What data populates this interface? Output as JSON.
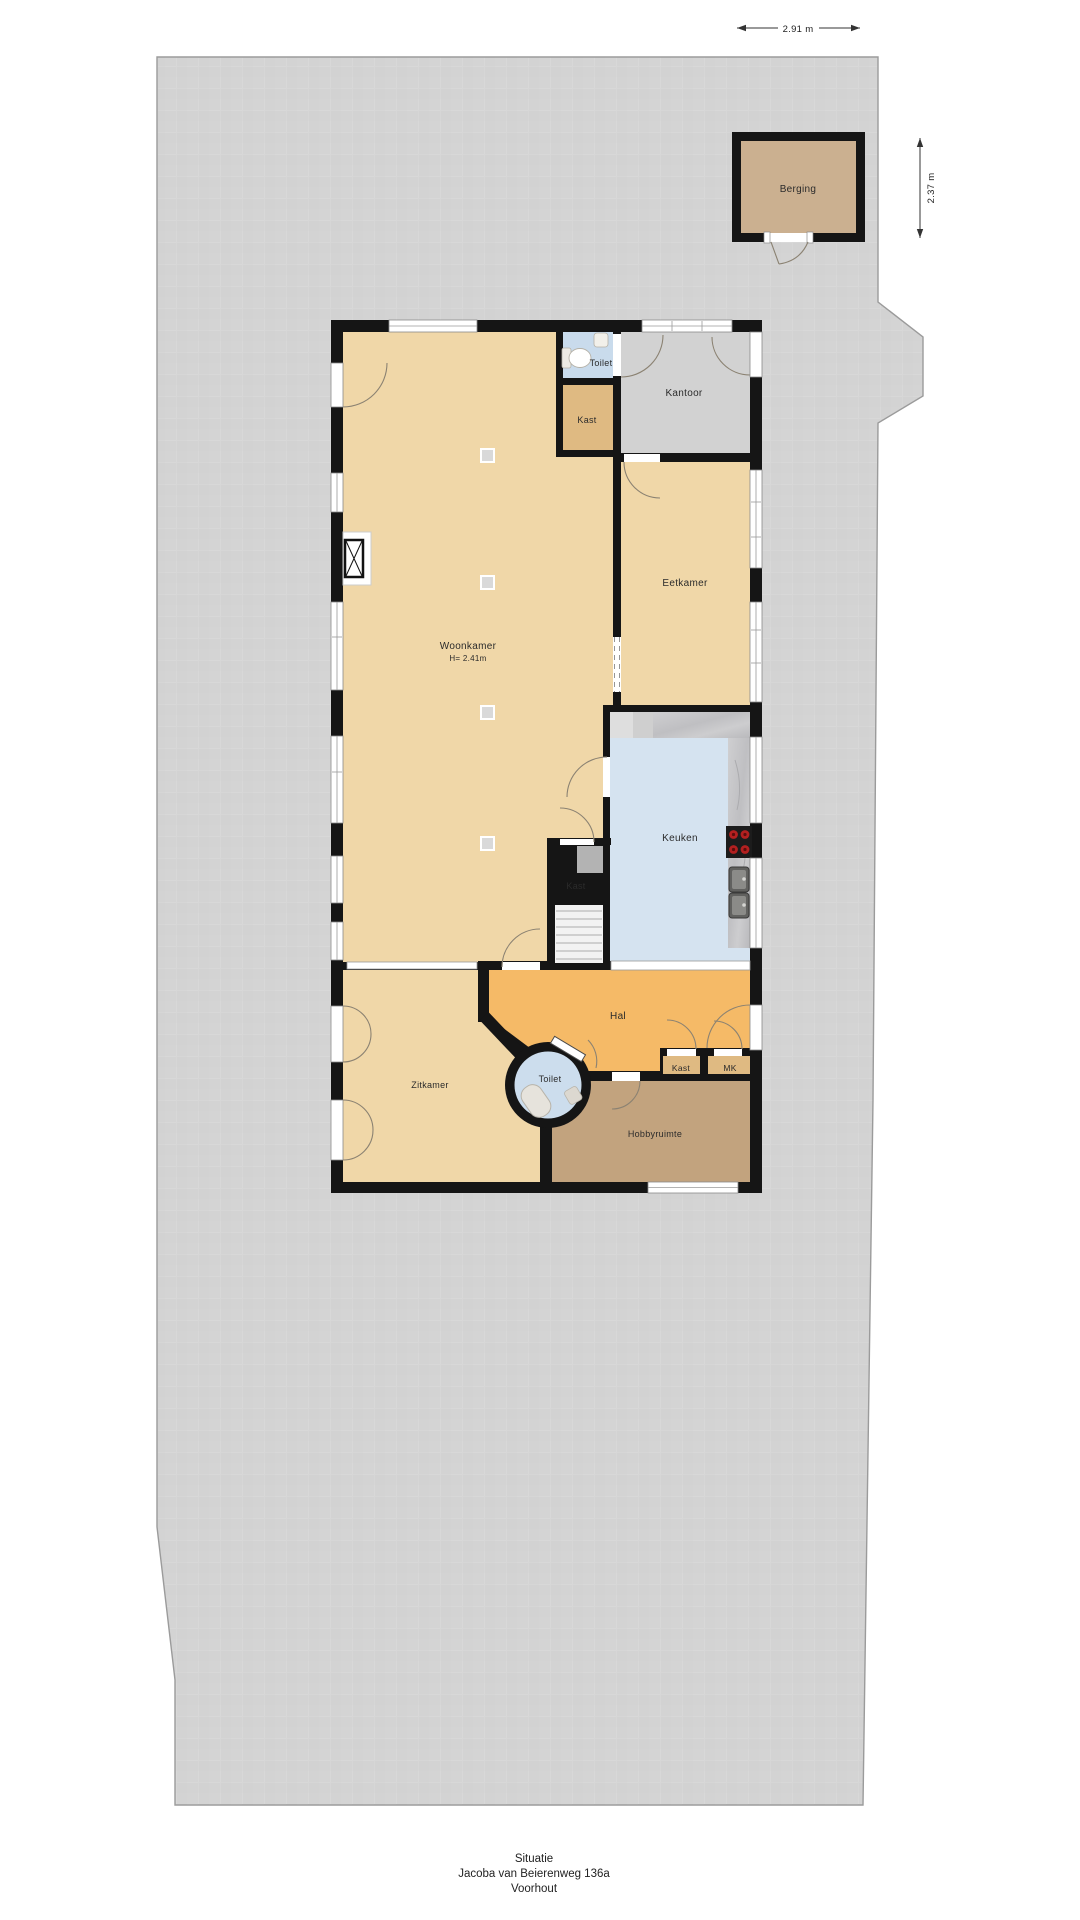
{
  "caption": {
    "line1": "Situatie",
    "line2": "Jacoba van Beierenweg 136a",
    "line3": "Voorhout"
  },
  "measurements": {
    "berging_width": "2.91 m",
    "berging_depth": "2.37 m"
  },
  "rooms": {
    "berging": "Berging",
    "toilet_boven": "Toilet",
    "kast_boven": "Kast",
    "kantoor": "Kantoor",
    "eetkamer": "Eetkamer",
    "woonkamer": "Woonkamer",
    "woonkamer_hoogte": "H= 2.41m",
    "keuken": "Keuken",
    "kast_midden": "Kast",
    "hal": "Hal",
    "zitkamer": "Zitkamer",
    "toilet_rond": "Toilet",
    "kast_onder": "Kast",
    "mk": "MK",
    "hobbyruimte": "Hobbyruimte"
  },
  "colors": {
    "terrain": "#d3d3d3",
    "terrain_line": "#9b9b9b",
    "wall": "#151515",
    "floor_tan": "#f0d7a8",
    "floor_dark_tan": "#dfba82",
    "floor_orange": "#f5ba67",
    "floor_brown": "#c2a37e",
    "toilet_blue": "#c9dbec",
    "kitchen_blue": "#d5e3f0",
    "kantoor_gray": "#d2d2d2",
    "berging_floor": "#cbb090",
    "counter_marble": "#c6c6c8",
    "stove": "#1c1c1c",
    "burner": "#b32020"
  }
}
